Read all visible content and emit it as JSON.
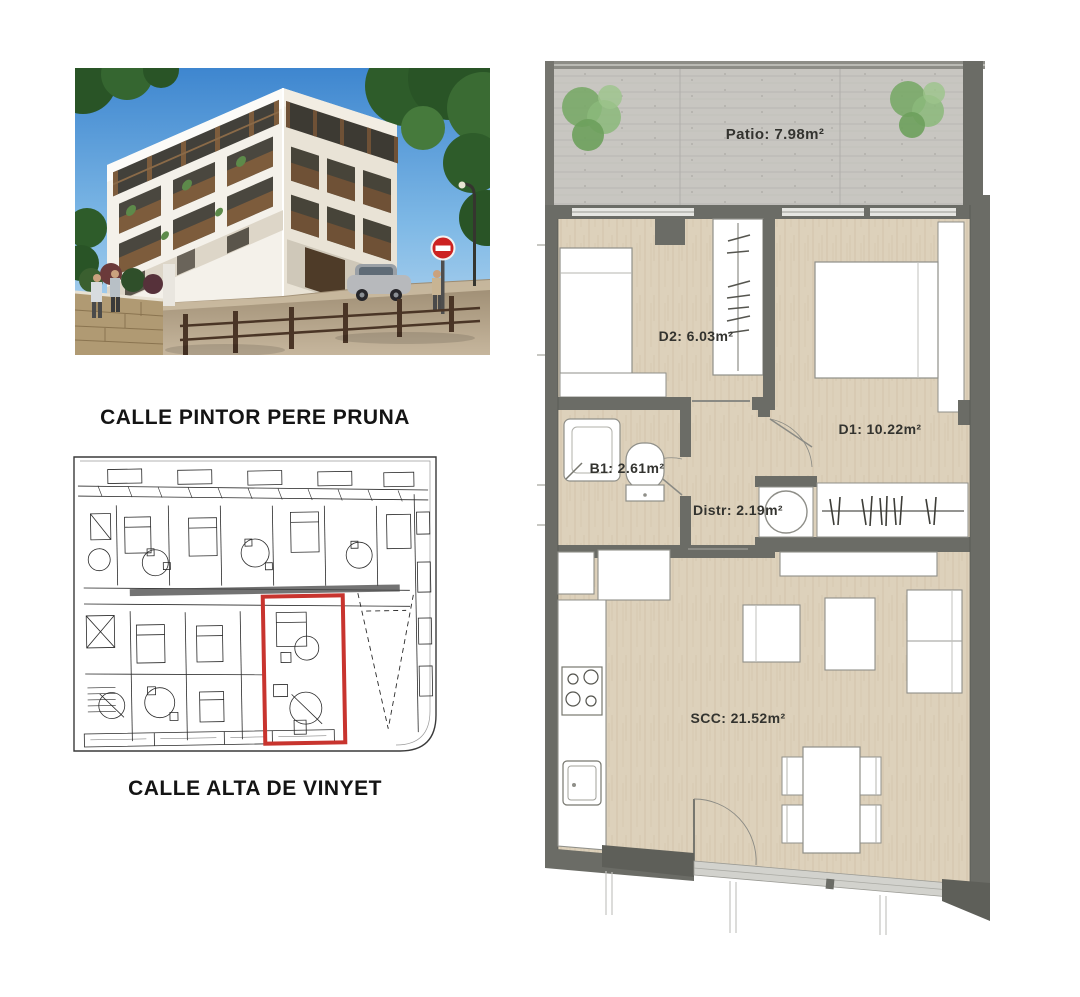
{
  "captions": {
    "top_street": "CALLE PINTOR PERE PRUNA",
    "bottom_street": "CALLE ALTA DE VINYET"
  },
  "floor_plan": {
    "rooms": [
      {
        "id": "patio",
        "label": "Patio: 7.98m²"
      },
      {
        "id": "d2",
        "label": "D2: 6.03m²"
      },
      {
        "id": "d1",
        "label": "D1: 10.22m²"
      },
      {
        "id": "b1",
        "label": "B1: 2.61m²"
      },
      {
        "id": "distr",
        "label": "Distr: 2.19m²"
      },
      {
        "id": "scc",
        "label": "SCC: 21.52m²"
      }
    ],
    "colors": {
      "wall": "#6b6c66",
      "floor_wood": "#ddd1bb",
      "patio_concrete": "#c8c6c1",
      "tree_green": "#79a968",
      "label_text": "#33332f"
    }
  },
  "site_plan": {
    "highlight_color": "#c8342e",
    "ink": "#2a2a2a"
  }
}
